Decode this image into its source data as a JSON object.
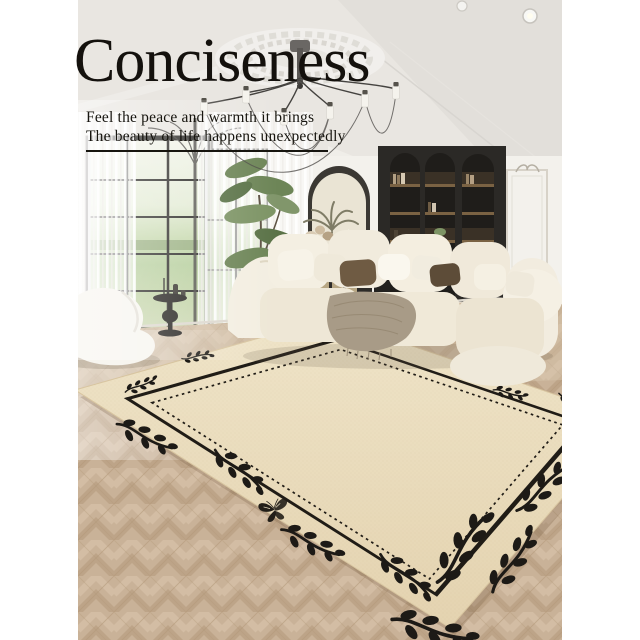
{
  "hero": {
    "title": "Conciseness",
    "tagline_line1": "Feel the peace and warmth it brings",
    "tagline_line2": "The beauty of life happens unexpectedly"
  },
  "palette": {
    "page_background": "#ffffff",
    "text_black": "#16130e",
    "rug_cream": "#ecdfc2",
    "rug_motif_black": "#201c16",
    "sofa_cream": "#f1ecdf",
    "wood_floor": "#c9b298",
    "wall_white": "#f3f1ec",
    "cabinet_charcoal": "#2b2926",
    "plant_green": "#6d8557"
  }
}
